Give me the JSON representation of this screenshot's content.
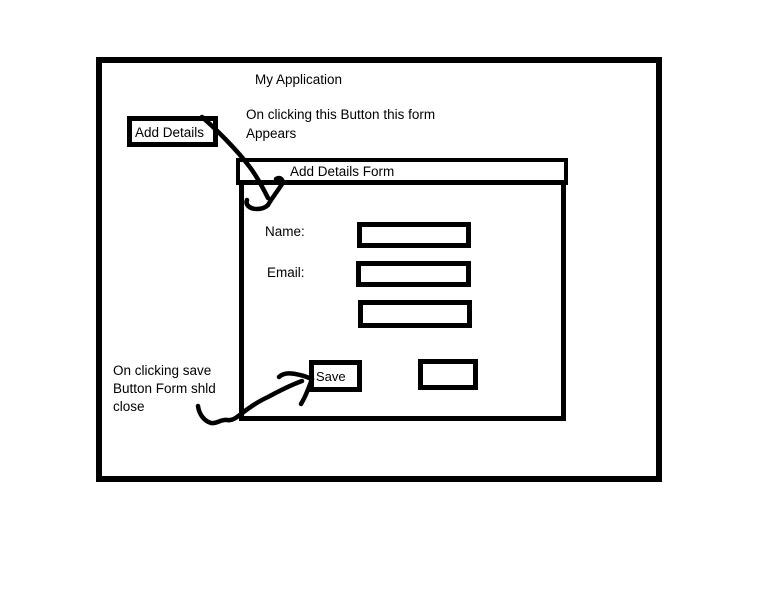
{
  "app": {
    "title": "My Application",
    "add_details_button_label": "Add Details"
  },
  "annotations": {
    "open_form_note": "On clicking this Button this form\nAppears",
    "save_note": "On clicking save\nButton Form shld\nclose"
  },
  "form": {
    "title": "Add Details Form",
    "fields": [
      {
        "label": "Name:",
        "value": ""
      },
      {
        "label": "Email:",
        "value": ""
      },
      {
        "label": "",
        "value": ""
      }
    ],
    "save_button_label": "Save",
    "unlabeled_button_label": ""
  },
  "colors": {
    "ink": "#000000",
    "background": "#ffffff"
  }
}
